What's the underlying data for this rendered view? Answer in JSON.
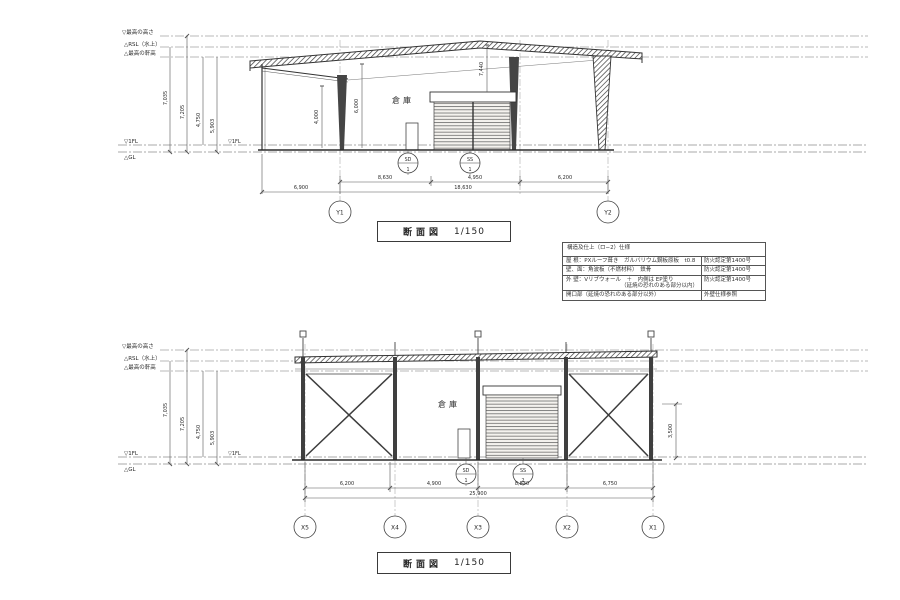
{
  "colors": {
    "ink": "#2b2b2b",
    "faint": "#8a8a8a",
    "paper": "#ffffff"
  },
  "datum": {
    "lines": [
      "▽最高の高さ",
      "△RSL（水上）",
      "△最高の軒高"
    ],
    "fl1": "▽1FL",
    "gl": "△GL"
  },
  "top": {
    "title": "断面図",
    "scale": "1/150",
    "room": "倉庫",
    "fl1_inner": "▽1FL",
    "vdims": [
      "7,035",
      "7,205",
      "4,750",
      "5,903"
    ],
    "inner_vdims": [
      "4,000",
      "6,000",
      "7,440"
    ],
    "row1": [
      "8,630",
      "4,950",
      "6,200"
    ],
    "row2": [
      "6,900",
      "18,630"
    ],
    "grids": [
      "Y1",
      "Y2"
    ],
    "tags": [
      {
        "code": "SD",
        "num": "1"
      },
      {
        "code": "SS",
        "num": "1"
      }
    ]
  },
  "bottom": {
    "title": "断面図",
    "scale": "1/150",
    "room": "倉庫",
    "fl1_inner": "▽1FL",
    "vdims": [
      "7,035",
      "7,205",
      "4,750",
      "5,903"
    ],
    "right_vdim": "3,500",
    "row1": [
      "6,200",
      "4,900",
      "8,830",
      "6,750"
    ],
    "row2": [
      "25,900"
    ],
    "grids": [
      "X5",
      "X4",
      "X3",
      "X2",
      "X1"
    ],
    "tags": [
      {
        "code": "SD",
        "num": "1"
      },
      {
        "code": "SS",
        "num": "2"
      }
    ]
  },
  "spec": {
    "title": "構造及仕上（ロ−2）仕様",
    "rows": [
      {
        "left": "屋 根：PXルーフ葺き　ガルバリウム鋼板原板　t0.8",
        "right": "防火認定第1400号"
      },
      {
        "left": "壁、面：角波板（不燃材料）　鉄骨",
        "right": "防火認定第1400号"
      },
      {
        "left": "外 壁：Vリブウォール　＋　内側は EP塗り",
        "left2": "（延焼の恐れのある部分以内）",
        "right": "防火認定第1400号"
      },
      {
        "left": "開口部（延焼の恐れのある部分以外）",
        "right": "外壁仕様参照"
      }
    ]
  }
}
